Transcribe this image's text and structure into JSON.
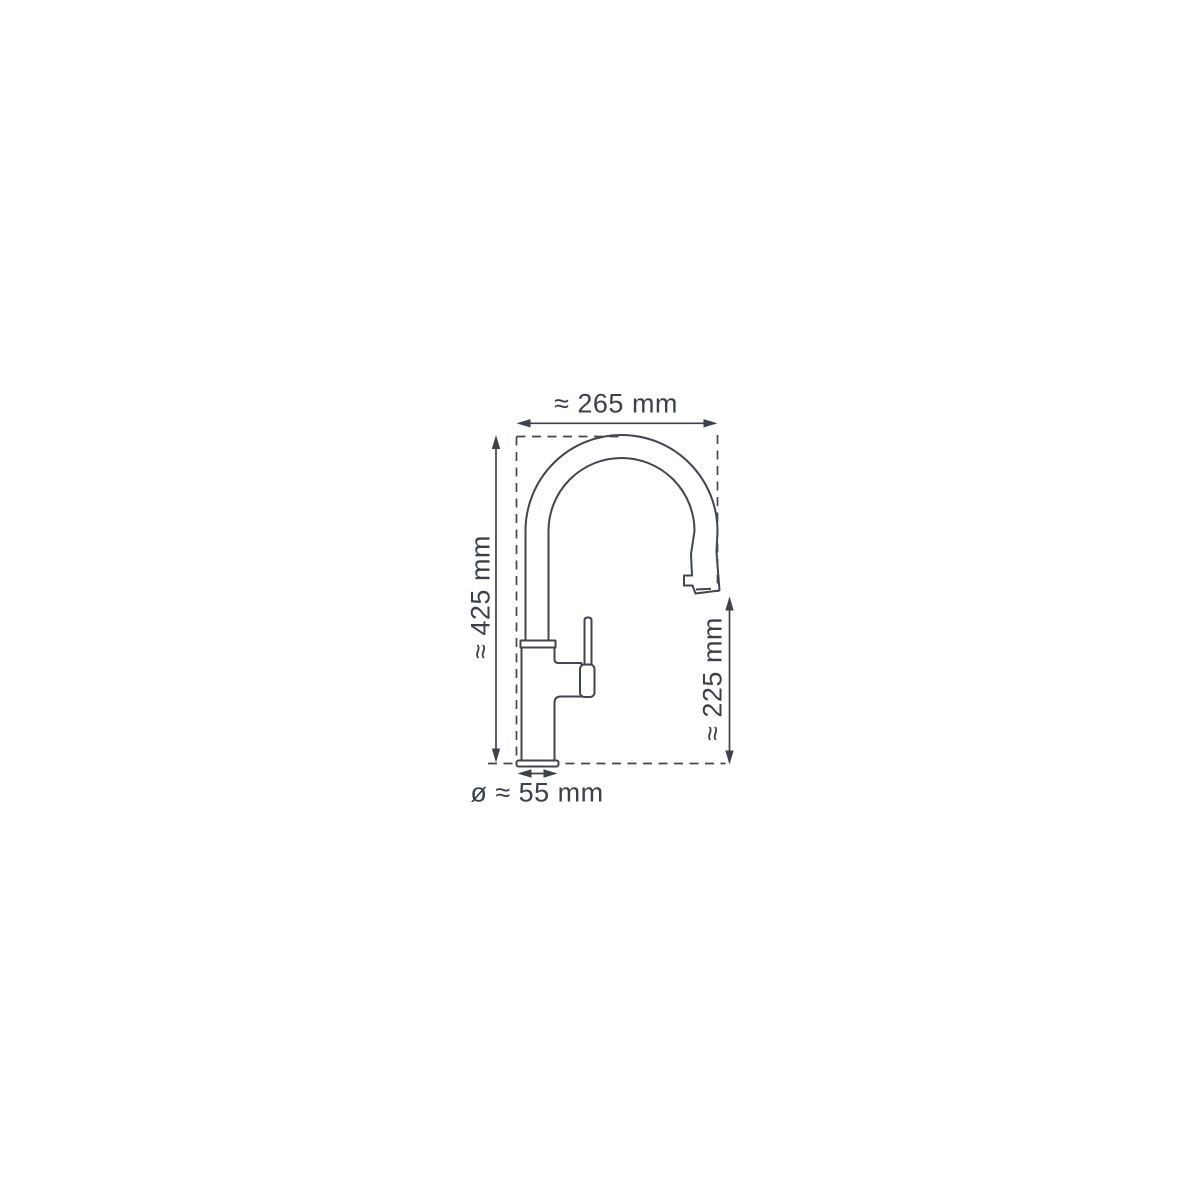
{
  "diagram": {
    "type": "faucet-dimension-drawing",
    "colors": {
      "line": "#40464e",
      "dimension_line": "#3d434b",
      "text": "#3b414a",
      "background": "#ffffff"
    },
    "dimensions": {
      "outreach": {
        "label": "≈ 265 mm",
        "position": "top",
        "orientation": "horizontal"
      },
      "overall_height": {
        "label": "≈ 425 mm",
        "position": "left",
        "orientation": "vertical"
      },
      "outlet_height": {
        "label": "≈ 225 mm",
        "position": "right",
        "orientation": "vertical"
      },
      "base_diameter": {
        "label": "ø ≈ 55 mm",
        "position": "bottom",
        "orientation": "horizontal"
      }
    }
  }
}
